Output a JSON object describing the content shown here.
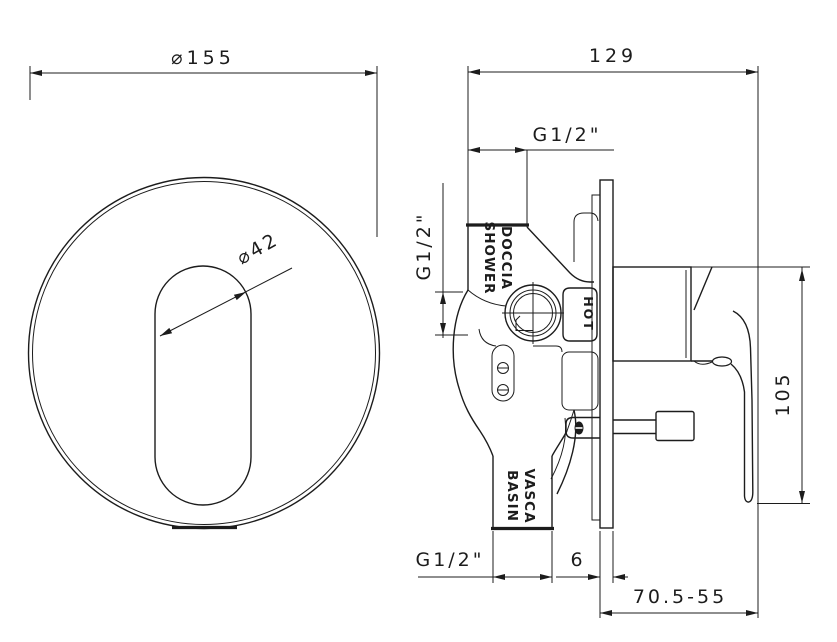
{
  "drawing": {
    "front_view": {
      "plate_diameter_label": "⌀155",
      "cutout_diameter_label": "⌀42"
    },
    "side_view": {
      "width_label": "129",
      "top_thread_label": "G1/2\"",
      "inlet_thread_label": "G1/2\"",
      "hot_label": "HOT",
      "top_port_line1": "DOCCIA",
      "top_port_line2": "SHOWER",
      "bottom_port_line1": "VASCA",
      "bottom_port_line2": "BASIN",
      "bottom_thread_label": "G1/2\"",
      "plate_thickness_label": "6",
      "height_label": "105",
      "depth_range_label": "70.5-55"
    },
    "colors": {
      "line": "#1c1c1c",
      "background": "#ffffff"
    }
  }
}
